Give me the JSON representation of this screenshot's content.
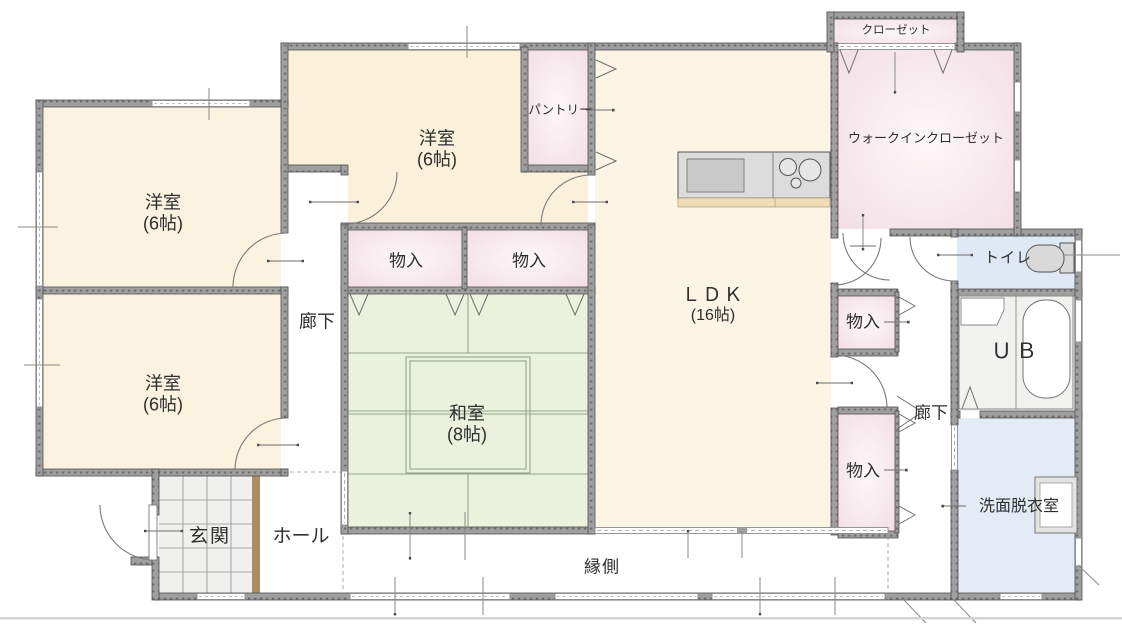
{
  "plan_title": "1F floor plan",
  "rooms": {
    "western_room": {
      "name": "洋室",
      "size": "(6帖)"
    },
    "japanese_room": {
      "name": "和室",
      "size": "(8帖)"
    },
    "ldk": {
      "name": "ＬＤＫ",
      "size": "(16帖)"
    },
    "pantry": {
      "name": "パントリー"
    },
    "closet": {
      "name": "クローゼット"
    },
    "walk_in_closet": {
      "name": "ウォークインクローゼット"
    },
    "toilet": {
      "name": "トイレ"
    },
    "unit_bath": {
      "name": "ＵＢ"
    },
    "washroom": {
      "name": "洗面脱衣室"
    },
    "entrance": {
      "name": "玄関"
    },
    "hall": {
      "name": "ホール"
    },
    "engawa": {
      "name": "縁側"
    },
    "corridor": {
      "name": "廊下"
    },
    "storage": {
      "name": "物入"
    }
  },
  "palette": {
    "wall_gray": "#9f9f9f",
    "wall_edge": "#4f4f4f",
    "room_cream": "#fbf2e0",
    "room_pink": "#f5e3e8",
    "room_green": "#eaf1dd",
    "room_blue": "#dfe8f5",
    "tile_gray": "#f0f0ee",
    "step_brown": "#ad8c5d",
    "fixture_gray": "#d9d9d9"
  }
}
